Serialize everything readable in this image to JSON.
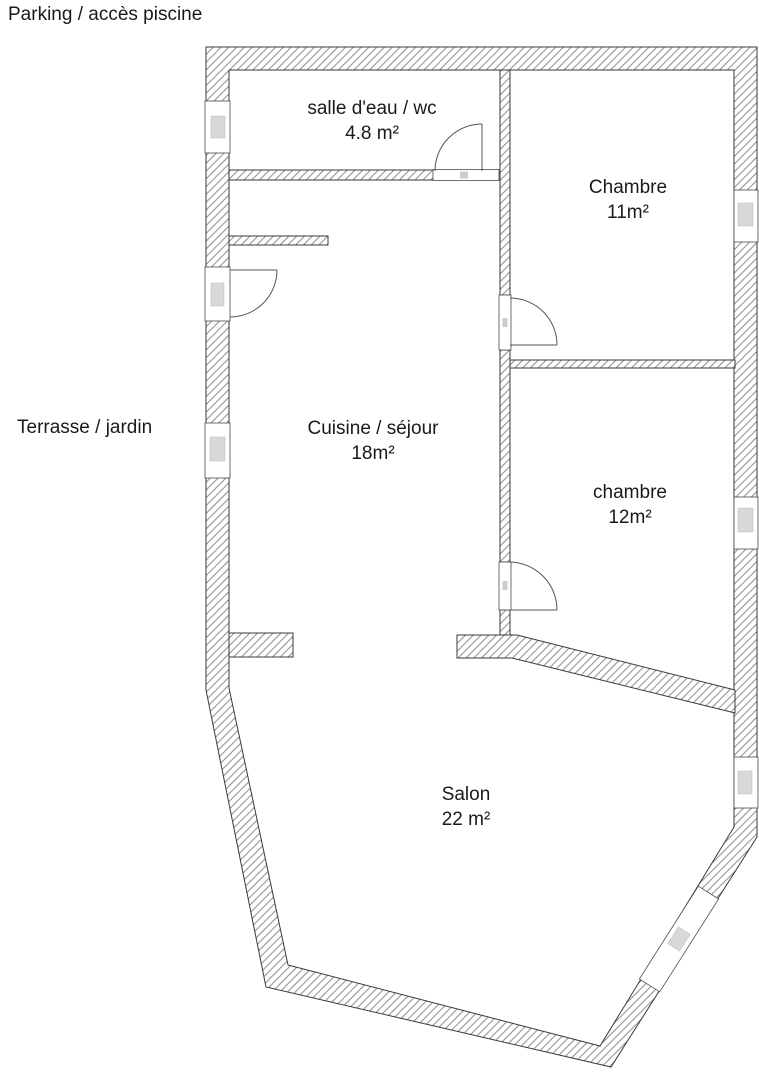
{
  "outside": {
    "parking_label": "Parking / accès piscine",
    "terrasse_label": "Terrasse / jardin"
  },
  "rooms": [
    {
      "name": "salle d'eau / wc",
      "area": "4.8 m²"
    },
    {
      "name": "Chambre",
      "area": "11m²"
    },
    {
      "name": "Cuisine / séjour",
      "area": "18m²"
    },
    {
      "name": "chambre",
      "area": "12m²"
    },
    {
      "name": "Salon",
      "area": "22 m²"
    }
  ],
  "colors": {
    "background": "#ffffff",
    "text": "#1a1a1a",
    "wall_outline": "#3a3a3a",
    "hatch": "#6e6e6e",
    "window_glass": "#d8d8d8",
    "opening_stroke": "#4a4a4a"
  }
}
